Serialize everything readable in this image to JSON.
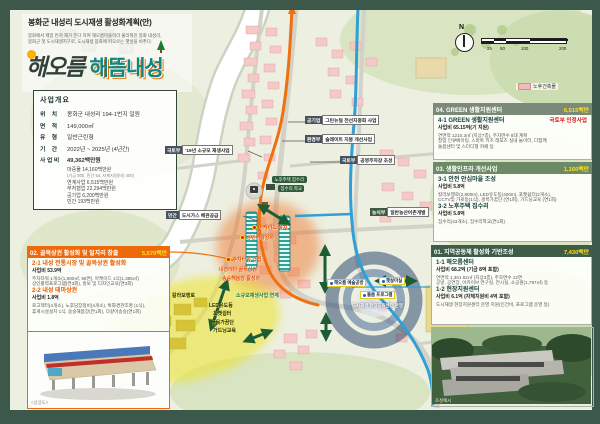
{
  "colors": {
    "frame": "#3c584a",
    "map_bg": "#edefe0",
    "accent_orange": "#ed6a0c",
    "accent_yellow": "#ffe11a",
    "panel_green_dark": "#3f5c49",
    "panel_green_mid": "#6d8a66",
    "panel_gray_green": "#7b8a78",
    "route_orange": "#f07010",
    "route_blue": "#2f9fd6",
    "old_building_pink": "#f2baba"
  },
  "header": {
    "title": "봉화군 내성리 도시재생 활성화계획(안)",
    "desc_line1": "봉화에서 제일 먼저 해가 뜬다 하여 해오름마을이라 불리워진 봉화 내성리,",
    "desc_line2": "봉화군 첫 도시재생지구로, 도시재생 봉화에 떠오르는 햇살을 비추다.",
    "logo_script": "해오름",
    "logo_main": "해뜸내성"
  },
  "overview": {
    "title": "사업개요",
    "rows": [
      {
        "label": "위    치",
        "value": "봉화군 내성리 194-1번지 일원"
      },
      {
        "label": "면    적",
        "value": "149,000㎡"
      },
      {
        "label": "유    형",
        "value": "일반근린형"
      },
      {
        "label": "기    간",
        "value": "2022년 ~ 2025년 (4년간)"
      },
      {
        "label": "사 업 비",
        "value": "49,362백만원"
      }
    ],
    "budget_details": [
      "마중물 14,160백만원",
      "(기금 800, 민간 54, 자체지원(비) 400)",
      "연계사업 6,515백만원",
      "부처협업 22,294백만원",
      "공기업 6,200백만원",
      "민간 193백만원"
    ]
  },
  "panels": {
    "p02": {
      "title": "02. 골목상권 활성화 및 일자리 창출",
      "amount": "5,570백만",
      "items": [
        {
          "name": "2-1 내성 전통시장 및 골목상권 활성화",
          "cost": "사업비 53.9억",
          "lines": [
            "주차타워 1개소(1,800㎡, 86면), 아케이드 1식(1,385㎡)",
            "상인활력프로그램(연3회), 홍보 및 디자인교육(연3회)"
          ]
        },
        {
          "name": "2-2 내성 테마상권",
          "cost": "사업비 1.8억",
          "lines": [
            "로고젝터(4개소), 노후담장정비(4개소), 특화경관조명 (1식),",
            "휴게시설설치 1식, 송숭해봄장(연1회), 다같이송숭(연1회)"
          ]
        }
      ],
      "photo_caption": "<상상도>"
    },
    "p04": {
      "title": "04. GREEN 생활지원센터",
      "amount": "6,515백만",
      "tag": "국토부 인정사업",
      "items": [
        {
          "name": "4-1 GREEN 생활지원센터",
          "cost": "사업비 65.15억(기 지원)",
          "lines": [
            "연면적 1210.3㎡ (지상7층), 주차면수 8대 계획",
            "창업 인큐베이팅, 스마트 키즈 레포츠 실내 놀이터, 다함께",
            "돌봄센터 및 스터디형 카페 등"
          ]
        }
      ]
    },
    "p03": {
      "title": "03. 생활인프라 개선사업",
      "amount": "1,160백만",
      "items": [
        {
          "name": "3-1 안전 안심마을 조성",
          "cost": "사업비 5.8억",
          "lines": [
            "칼라보행로(2,800m), LED유도등(400m), 포켓쉼터(2개소),",
            "CCTV및 가로등(1식), 골목가꿈단 (연1회), 가드닝교육 (연1회)"
          ]
        },
        {
          "name": "3-2 노후주택 집수리",
          "cost": "사업비 5.8억",
          "lines": [
            "집수리(43개소), 집수리학교(연1회)"
          ]
        }
      ]
    },
    "p01": {
      "title": "01. 지역공동체 활성화 기반조성",
      "amount": "7,430백만",
      "items": [
        {
          "name": "1-1 해오름센터",
          "cost": "사업비 68.2억 (기금 8억 포함)",
          "lines": [
            "연면적 1,301.62㎡ (지상3층), 주차면수 12면",
            "공방, 공연장, 아카이브 연구실, 전시실, 소공원(1,797㎡) 등"
          ]
        },
        {
          "name": "1-2 현장지원센터",
          "cost": "사업비 6.1억 (자체지원비 4억 포함)",
          "lines": [
            "도시재생 현장지원센터 운영 지원(인건비, 프로그램 운영 등)"
          ]
        }
      ],
      "photo_caption": "조성예시"
    }
  },
  "map": {
    "compass_label": "N",
    "scale_ticks": [
      "25",
      "50",
      "100",
      "200"
    ],
    "legend": [
      {
        "label": "노후건축물"
      }
    ],
    "ministry_labels": [
      {
        "badge": "공기업",
        "text": "그린뉴딜 전선지중화 사업"
      },
      {
        "badge": "환경부",
        "text": "슬레이트 지붕 개선사업"
      },
      {
        "badge": "국토부",
        "text": "공영주차장 조성"
      },
      {
        "badge": "국토부",
        "text": "'19년 소규모 재생사업"
      },
      {
        "badge": "민간",
        "text": "도시가스 배관공급"
      },
      {
        "badge": "농식부",
        "text": "일반농산어촌개발"
      }
    ],
    "market_labels": [
      "아케이드 설치",
      "상인역량강화",
      "주차타워 건립",
      "내성테마 골목상권",
      "송숭해봄장 활성화"
    ],
    "safe_labels": [
      "칼라보행로",
      "LED유도등",
      "포켓쉼터",
      "골목가꿈단",
      "가드닝교육"
    ],
    "safe_note": "소규모재생사업 연계",
    "repair_labels": [
      "노후주택 집수리",
      "집수리 학교"
    ],
    "center_labels": [
      "해오름 예술공방",
      "햇살마실",
      "돌봄 프로그램",
      "도시재생 현장지원센터 운영"
    ]
  }
}
